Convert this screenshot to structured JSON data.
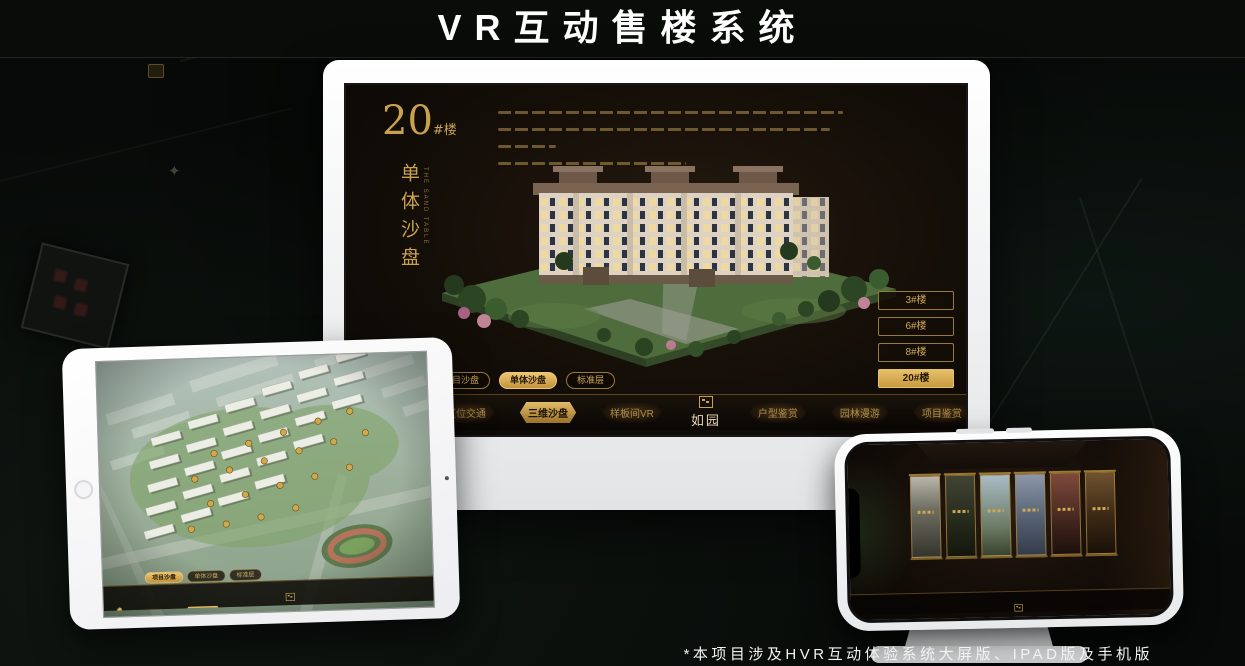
{
  "header": {
    "title": "VR互动售楼系统"
  },
  "footer": {
    "note": "*本项目涉及HVR互动体验系统大屏版、IPAD版及手机版"
  },
  "nav": {
    "logo": "如园",
    "items": [
      "区位交通",
      "三维沙盘",
      "样板间VR",
      "户型鉴赏",
      "园林漫游",
      "项目鉴赏"
    ]
  },
  "desktop": {
    "unit_number": "20",
    "unit_suffix": "#楼",
    "subtitle": "单体沙盘",
    "subtitle_en": "THE SAND TABLE",
    "sub_tabs": [
      "项目沙盘",
      "单体沙盘",
      "标准层"
    ],
    "active_sub_tab": "单体沙盘",
    "floor_buttons": [
      "3#楼",
      "6#楼",
      "8#楼",
      "20#楼"
    ],
    "active_floor_button": "20#楼",
    "active_nav_item": "三维沙盘"
  },
  "tablet": {
    "sub_tabs": [
      "项目沙盘",
      "单体沙盘",
      "标准层"
    ],
    "active_sub_tab": "项目沙盘",
    "active_nav_item": "三维沙盘"
  },
  "phone": {
    "active_nav_item": "园林漫游"
  },
  "decor": {
    "compass_glyph": "✦"
  },
  "colors": {
    "gold": "#d0a54f",
    "gold_deep": "#8a6a2e",
    "screen_bg": "#140e08",
    "page_bg": "#070a08",
    "device_white": "#f2f3f4"
  }
}
